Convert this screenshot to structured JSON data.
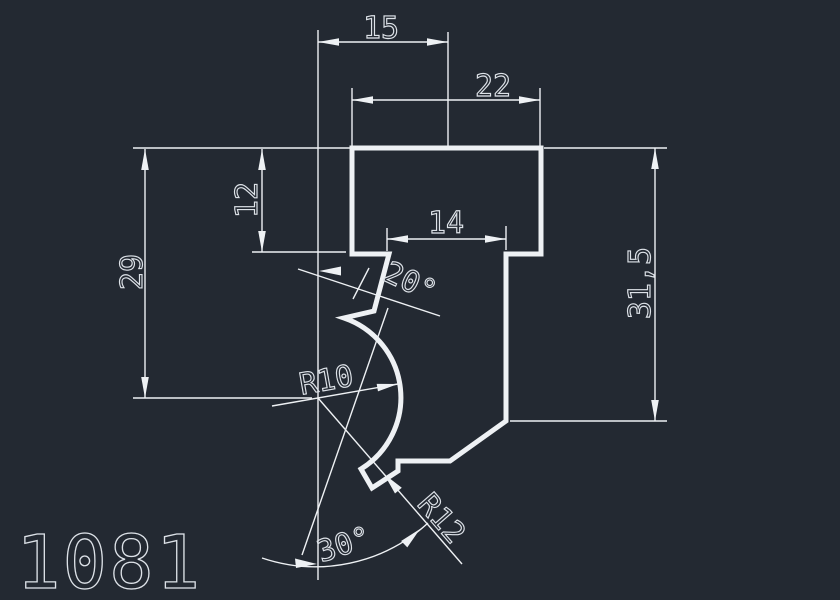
{
  "drawing": {
    "part_number": "1081",
    "dimensions": {
      "top_offset": "15",
      "hat_width": "22",
      "step_depth": "12",
      "left_height": "29",
      "stem_width": "14",
      "right_height": "31,5",
      "slot_angle": "20°",
      "groove_radius": "R10",
      "tip_radius": "R12",
      "tip_angle": "30°"
    },
    "colors": {
      "background": "#232932",
      "line": "#eef1f4",
      "text": "#dde2e8"
    }
  }
}
